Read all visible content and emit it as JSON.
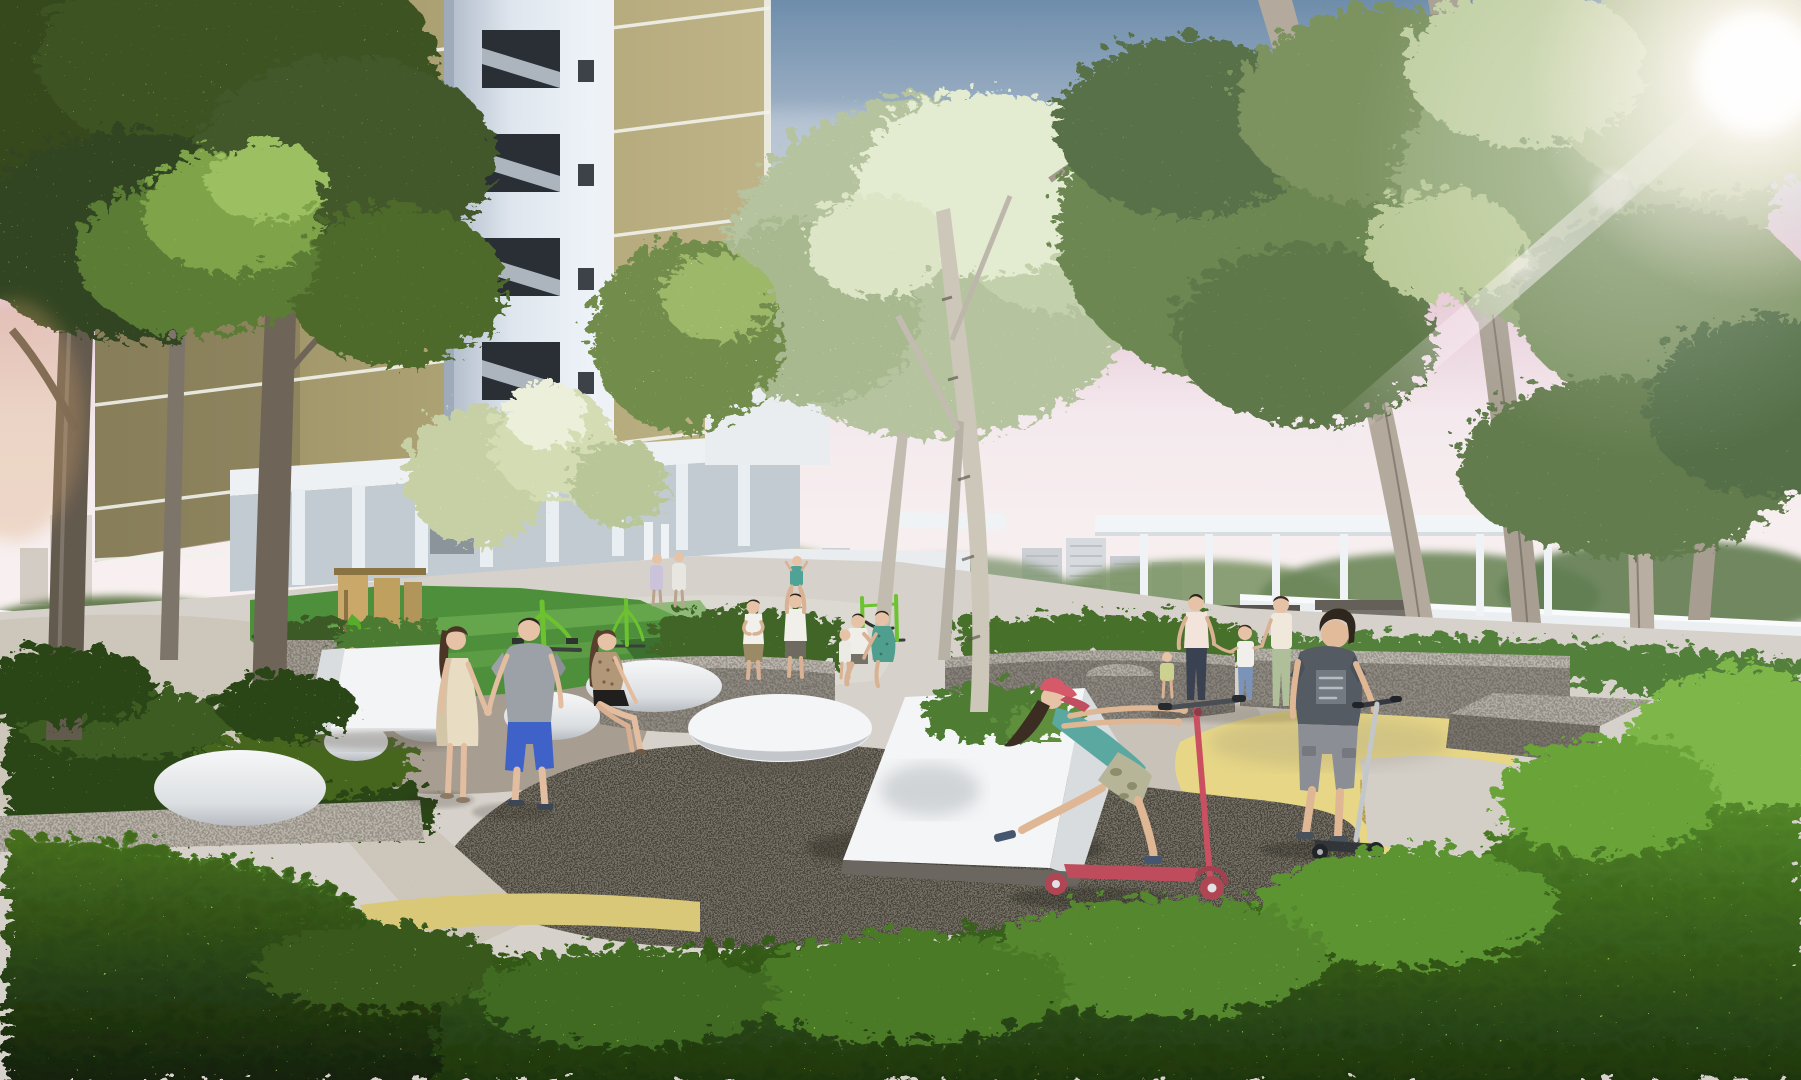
{
  "scene": {
    "type": "architectural-rendering",
    "subject": "Residential estate landscape deck: plaza with pebble seats, play corner, scooter-riding children, tower block and dense hedges",
    "lighting": "warm afternoon sun from upper right with lens flare",
    "sky": "steel blue fading through pink haze to a pale horizon"
  },
  "colors": {
    "sky_top": "#6e8dab",
    "sky_mid": "#a9b9cb",
    "sky_pink": "#e5c4d3",
    "sky_pale": "#f4eaee",
    "sky_horizon": "#fbf5f1",
    "facade": "#b1a678",
    "facade_shadow": "#8d845c",
    "facade_line": "#f1f2ec",
    "stair_core": "#e2e8f0",
    "stair_opening": "#2a2f35",
    "parapet": "#eceff1",
    "pergola": "#f2f5f7",
    "tower_distant": "#ccd0d6",
    "turf": "#4e8f3c",
    "turf_light": "#6fae52",
    "equipment_green": "#6cc22f",
    "play_timber": "#c9a869",
    "granite_light": "#b5b0a7",
    "granite": "#8f8a82",
    "granite_dark": "#6e6a63",
    "paving_base": "#d6d1ca",
    "paving_taupe": "#a79d91",
    "paving_yellow": "#e6d686",
    "paving_gold": "#cfb55e",
    "asphalt": "#4c463d",
    "pebble_top": "#f4f5f6",
    "pebble_shade": "#bcc1c7",
    "wedge_white": "#f4f5f7",
    "hedge_dark": "#2f4a1d",
    "hedge_mid": "#4f7d2a",
    "hedge_light": "#79b23e",
    "canopy_dark": "#41572f",
    "canopy_mid": "#6d8752",
    "canopy_pale": "#b5c49e",
    "canopy_bright": "#e4ecd2",
    "trunk_pale": "#b3aa9d",
    "trunk_dark": "#5e564b",
    "skin": "#e6c2a6",
    "cap_red": "#d6596a",
    "scooter_pink": "#c94f61",
    "boy_tee": "#555b63",
    "sun": "#fffdfa"
  },
  "people": [
    {
      "id": "walking-woman",
      "where": "centre-left path",
      "outfit": "cream sleeveless dress, long brown hair"
    },
    {
      "id": "walking-man",
      "where": "holding her hand",
      "outfit": "grey t-shirt, blue knee shorts"
    },
    {
      "id": "sitting-woman",
      "where": "on pebble bench",
      "outfit": "floral blouse, black shorts"
    },
    {
      "id": "clapping-woman",
      "where": "mid plaza",
      "outfit": "white top, khaki skirt"
    },
    {
      "id": "father-lifting-child",
      "where": "mid plaza",
      "outfit": "white shirt; child in teal"
    },
    {
      "id": "seated-family",
      "where": "right planter bench",
      "members": [
        "man in white",
        "woman in teal dress",
        "toddler in white"
      ]
    },
    {
      "id": "strolling-family",
      "where": "under right pergola",
      "members": [
        "father in pale polo",
        "toddler in lime",
        "girl in white tee and jeans",
        "mother in cream top and sage trousers"
      ]
    },
    {
      "id": "girl-on-scooter",
      "where": "foreground right of centre",
      "outfit": "red cap, teal tank top, camo shorts",
      "ride": "pink kick scooter"
    },
    {
      "id": "boy-on-scooter",
      "where": "right foreground",
      "outfit": "charcoal graphic tee, grey cargo shorts",
      "ride": "silver kick scooter"
    },
    {
      "id": "pair-at-void-deck",
      "where": "under tower void deck",
      "members": [
        "adult in lavender",
        "adult in white"
      ]
    }
  ],
  "objects": {
    "pebble_benches": 6,
    "scooters": 2,
    "fitness_stations": 3,
    "timber_play_structure": 1,
    "pergola_columns": 7,
    "tower_floor_lines": 6,
    "stair_openings": 5,
    "distant_tower_clusters": 3
  },
  "building": {
    "kind": "residential tower, khaki facade with white floor bands and white stair core over an open void deck",
    "void_deck": "white columns above bright green play turf"
  },
  "ground": {
    "plaza": "organic patches of grey, taupe and yellow resin over dark asphalt",
    "foreground": "dense clipped hedge bank across the bottom of the view"
  }
}
